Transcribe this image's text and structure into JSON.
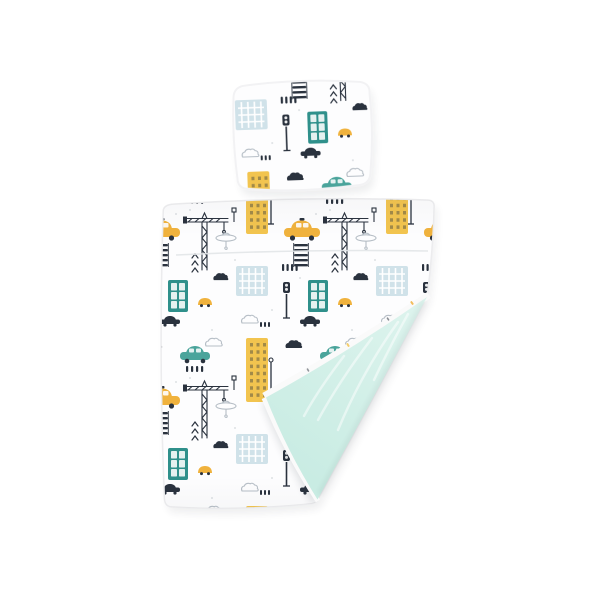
{
  "scene": {
    "title": "Kids bedding set with city traffic print: square pillow and duvet with folded corner showing mint underside",
    "background_color": "#ffffff",
    "items": [
      {
        "name": "pillow",
        "print": "city-traffic"
      },
      {
        "name": "duvet",
        "print": "city-traffic",
        "underside": "mint",
        "state": "corner-folded"
      }
    ]
  },
  "print_motifs": [
    "yellow-taxi",
    "teal-car",
    "small-yellow-car",
    "car-silhouette",
    "tower-crane",
    "crane-cab",
    "skyscraper-yellow",
    "building-blue",
    "phone-booth-teal",
    "cloud-navy",
    "cloud-outline",
    "crosswalk-ladder",
    "crosswalk-dashes",
    "traffic-light",
    "street-lamp",
    "road-sign",
    "chevrons"
  ],
  "colors": {
    "background": "#ffffff",
    "fabric": "#fdfdfe",
    "ink": "#2a323e",
    "outline_gray": "#b6bec6",
    "taxi_yellow": "#f0b23d",
    "building_yellow": "#f2c44f",
    "teal_dark": "#2f908b",
    "teal_car": "#4aa49b",
    "building_blue": "#d0e2e9",
    "mint_light": "#def4ee",
    "mint_deep": "#c9ece3",
    "piping": "#ececee",
    "seam": "#e2e5e8"
  }
}
